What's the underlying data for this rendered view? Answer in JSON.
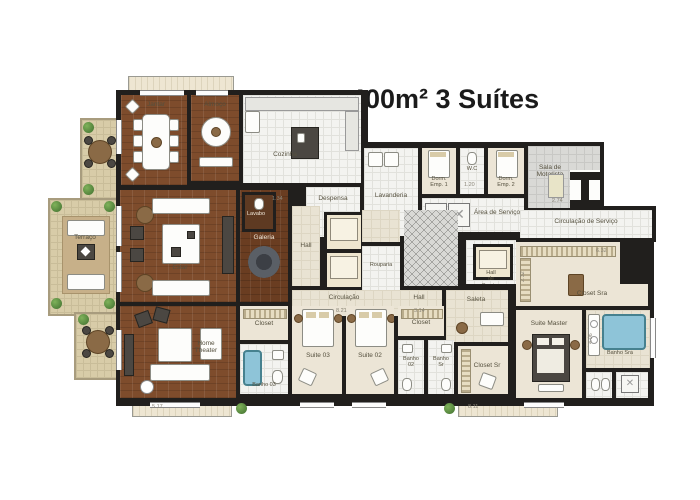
{
  "title": "400m² 3 Suítes",
  "rooms": {
    "jantar": "Jantar",
    "almoco": "Almoço",
    "cozinha": "Cozinha",
    "terraco": "Terraço",
    "estar": "Estar",
    "galeria": "Galeria",
    "lavabo": "Lavabo",
    "hall_central": "Hall",
    "despensa": "Despensa",
    "lavanderia": "Lavanderia",
    "dorm_emp_1": "Dorm.\nEmp. 1",
    "wc": "W.C",
    "dorm_emp_2": "Dorm.\nEmp. 2",
    "area_servico": "Área de Serviço",
    "sala_motorista": "Sala de\nMotorista",
    "hall_servico": "Hall\nde\nServiço",
    "circ_servico": "Circulação de Serviço",
    "rouparia": "Rouparia",
    "circulacao": "Circulação",
    "hall_suites": "Hall",
    "saleta": "Saleta",
    "closet_03": "Closet",
    "banho_03": "Banho 03",
    "suite_03": "Suite 03",
    "suite_02": "Suite 02",
    "banho_02": "Banho\n02",
    "banho_sr": "Banho\nSr",
    "closet_02": "Closet",
    "closet_sr": "Closet Sr",
    "suite_master": "Suite Master",
    "closet_sra": "Closet Sra",
    "banho_sra": "Banho Sra",
    "home_theater": "Home\nTheater"
  },
  "dimensions": [
    "5.17",
    "8.11",
    "8.21",
    "3.14",
    "2.74",
    "6.32",
    "2.32",
    "1.20",
    "1.34",
    "4.06"
  ],
  "colors": {
    "wall": "#211f1d",
    "wood_floor": "#7e4c2c",
    "dark_wood_floor": "#6a3d21",
    "white_tile": "#f3f3f0",
    "gray_tile": "#d9d9d6",
    "bedroom_floor": "#ece5d6",
    "corridor_floor": "#e9e3d3",
    "terrace_floor": "#d8cca8",
    "bath_blue": "#8ec4d8",
    "plant_green": "#4f7d3a",
    "title_text": "#1b1b1b",
    "label_text": "#55503e"
  }
}
